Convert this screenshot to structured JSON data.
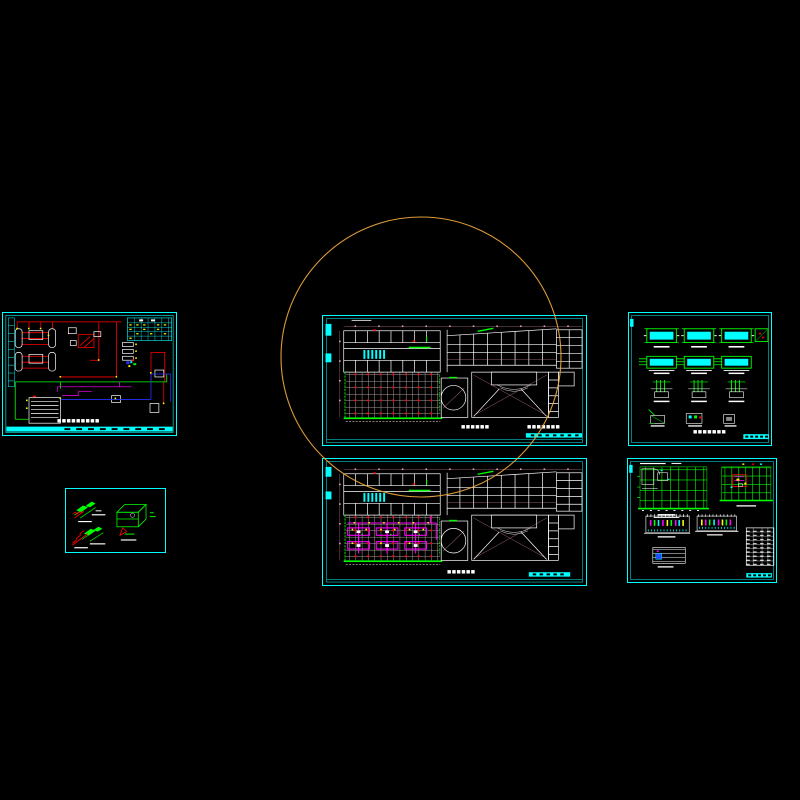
{
  "palette": {
    "sheet_border": "#00FFFF",
    "line_white": "#FFFFFF",
    "line_red": "#FF0000",
    "line_green": "#00FF00",
    "line_magenta": "#FF00FF",
    "line_yellow": "#FFFF00",
    "line_blue": "#2233FF",
    "line_pink": "#F0A0B4",
    "grid_line": "#A89898",
    "background": "#000000"
  },
  "overlay": {
    "revision_circle": {
      "color": "#E8A33C"
    }
  },
  "sheets": {
    "s1": {
      "title": "■■■■■■■■■"
    },
    "s3": {
      "title_main": "■■■■■■",
      "title_sub": "■■■■■■■"
    },
    "s4": {
      "title_main": "■■■■■■"
    },
    "s5": {
      "title": "■■■■■■■"
    }
  }
}
